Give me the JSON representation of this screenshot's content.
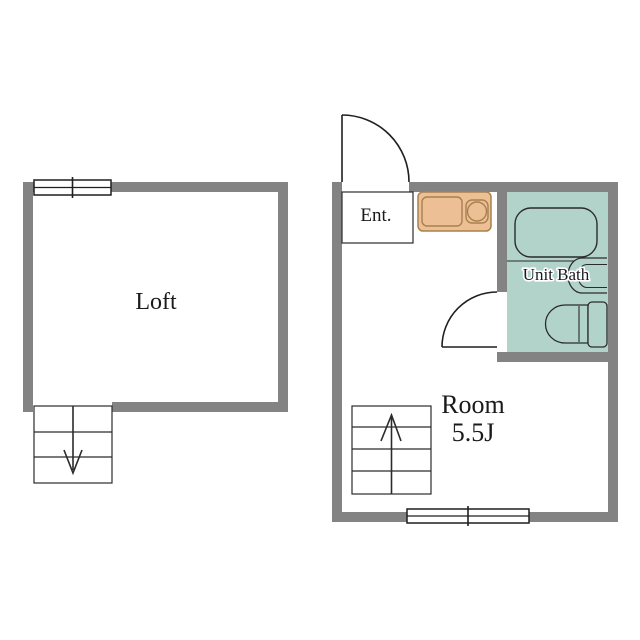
{
  "plan": {
    "loft": {
      "label": "Loft"
    },
    "main_floor": {
      "entrance": {
        "label": "Ent."
      },
      "unit_bath": {
        "label": "Unit Bath"
      },
      "room": {
        "label": "Room",
        "size": "5.5J"
      }
    }
  },
  "colors": {
    "wall": "#838383",
    "bath_fill": "#b2d3c9",
    "kitchen_fill": "#ecc094",
    "kitchen_stroke": "#a8814f",
    "line": "#1f1f1f",
    "background": "#ffffff"
  }
}
